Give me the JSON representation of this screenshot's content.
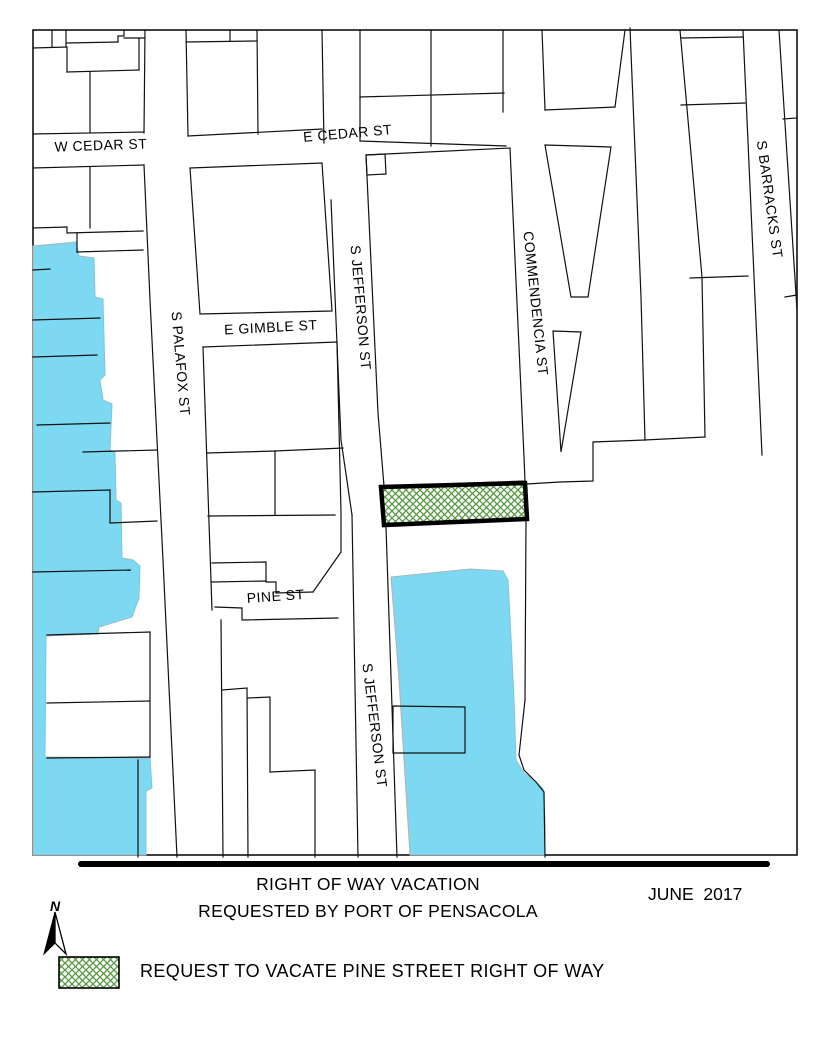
{
  "title_block": {
    "line1": "RIGHT OF WAY VACATION",
    "line2": "REQUESTED BY PORT OF PENSACOLA",
    "date": "JUNE  2017"
  },
  "north": {
    "label": "N"
  },
  "legend": {
    "item_label": "REQUEST TO VACATE PINE STREET RIGHT OF WAY"
  },
  "colors": {
    "water": "#7CD9F1",
    "water_outline": "#9FB9C2",
    "hatch_green": "#55973F",
    "parcel_line": "#111111",
    "vacation_border": "#000000"
  },
  "map": {
    "frame": {
      "x": 33,
      "y": 30,
      "w": 764,
      "h": 825
    },
    "street_labels": [
      {
        "text": "W CEDAR ST",
        "x": 101,
        "y": 150,
        "rot": -2,
        "size": 14
      },
      {
        "text": "E CEDAR ST",
        "x": 348,
        "y": 138,
        "rot": -5,
        "size": 14
      },
      {
        "text": "E GIMBLE ST",
        "x": 271,
        "y": 332,
        "rot": -3,
        "size": 14
      },
      {
        "text": "S PALAFOX ST",
        "x": 176,
        "y": 364,
        "rot": 85,
        "size": 14
      },
      {
        "text": "S JEFFERSON ST",
        "x": 356,
        "y": 308,
        "rot": 85,
        "size": 14
      },
      {
        "text": "COMMENDENCIA ST",
        "x": 531,
        "y": 304,
        "rot": 84,
        "size": 14
      },
      {
        "text": "S BARRACKS ST",
        "x": 765,
        "y": 200,
        "rot": 82,
        "size": 14
      },
      {
        "text": "PINE ST",
        "x": 276,
        "y": 601,
        "rot": -4,
        "size": 14
      },
      {
        "text": "S JEFFERSON ST",
        "x": 370,
        "y": 726,
        "rot": 83,
        "size": 14
      }
    ],
    "water_polygons": [
      [
        [
          33,
          246
        ],
        [
          76,
          242
        ],
        [
          79,
          256
        ],
        [
          94,
          258
        ],
        [
          95,
          297
        ],
        [
          103,
          299
        ],
        [
          105,
          375
        ],
        [
          100,
          380
        ],
        [
          103,
          400
        ],
        [
          112,
          404
        ],
        [
          110,
          450
        ],
        [
          115,
          452
        ],
        [
          116,
          500
        ],
        [
          121,
          503
        ],
        [
          122,
          558
        ],
        [
          133,
          560
        ],
        [
          140,
          566
        ],
        [
          139,
          598
        ],
        [
          132,
          617
        ],
        [
          99,
          627
        ],
        [
          98,
          634
        ],
        [
          46,
          636
        ],
        [
          45,
          757
        ],
        [
          150,
          758
        ],
        [
          152,
          788
        ],
        [
          146,
          791
        ],
        [
          146,
          855
        ],
        [
          33,
          855
        ]
      ],
      [
        [
          391,
          577
        ],
        [
          470,
          569
        ],
        [
          503,
          571
        ],
        [
          508,
          580
        ],
        [
          511,
          637
        ],
        [
          514,
          700
        ],
        [
          516,
          760
        ],
        [
          524,
          773
        ],
        [
          535,
          781
        ],
        [
          543,
          789
        ],
        [
          545,
          820
        ],
        [
          545,
          855
        ],
        [
          410,
          855
        ],
        [
          404,
          760
        ],
        [
          399,
          680
        ]
      ]
    ],
    "parcel_polygons": [
      [
        [
          190,
          168
        ],
        [
          322,
          163
        ],
        [
          332,
          311
        ],
        [
          200,
          314
        ]
      ],
      [
        [
          366,
          155
        ],
        [
          510,
          148
        ],
        [
          513,
          215
        ],
        [
          524,
          457
        ],
        [
          525,
          481
        ],
        [
          384,
          486
        ],
        [
          378,
          413
        ]
      ],
      [
        [
          366,
          155
        ],
        [
          385,
          154
        ],
        [
          386,
          174
        ],
        [
          367,
          175
        ]
      ],
      [
        [
          545,
          145
        ],
        [
          611,
          147
        ],
        [
          588,
          297
        ],
        [
          571,
          297
        ]
      ],
      [
        [
          553,
          331
        ],
        [
          581,
          332
        ],
        [
          561,
          452
        ]
      ],
      [
        [
          393,
          706
        ],
        [
          465,
          707
        ],
        [
          465,
          753
        ],
        [
          393,
          753
        ]
      ]
    ],
    "parcel_lines": [
      [
        [
          145,
          30
        ],
        [
          144,
          133
        ]
      ],
      [
        [
          33,
          134
        ],
        [
          144,
          132
        ]
      ],
      [
        [
          33,
          48
        ],
        [
          67,
          47
        ]
      ],
      [
        [
          67,
          43
        ],
        [
          118,
          42
        ]
      ],
      [
        [
          52,
          30
        ],
        [
          52,
          47
        ]
      ],
      [
        [
          66,
          30
        ],
        [
          66,
          47
        ]
      ],
      [
        [
          118,
          42
        ],
        [
          118,
          36
        ],
        [
          124,
          36
        ],
        [
          124,
          30
        ]
      ],
      [
        [
          124,
          38
        ],
        [
          144,
          38
        ]
      ],
      [
        [
          139,
          38
        ],
        [
          139,
          70
        ]
      ],
      [
        [
          67,
          48
        ],
        [
          67,
          72
        ]
      ],
      [
        [
          67,
          72
        ],
        [
          139,
          70
        ]
      ],
      [
        [
          90,
          72
        ],
        [
          90,
          132
        ]
      ],
      [
        [
          186,
          30
        ],
        [
          188,
          136
        ]
      ],
      [
        [
          257,
          30
        ],
        [
          258,
          134
        ]
      ],
      [
        [
          188,
          136
        ],
        [
          322,
          129
        ]
      ],
      [
        [
          186,
          42
        ],
        [
          257,
          41
        ]
      ],
      [
        [
          230,
          30
        ],
        [
          230,
          41
        ]
      ],
      [
        [
          322,
          30
        ],
        [
          324,
          143
        ]
      ],
      [
        [
          360,
          30
        ],
        [
          360,
          140
        ]
      ],
      [
        [
          360,
          97
        ],
        [
          504,
          93
        ]
      ],
      [
        [
          431,
          30
        ],
        [
          431,
          146
        ]
      ],
      [
        [
          503,
          30
        ],
        [
          503,
          112
        ]
      ],
      [
        [
          360,
          141
        ],
        [
          506,
          146
        ]
      ],
      [
        [
          542,
          30
        ],
        [
          545,
          110
        ]
      ],
      [
        [
          545,
          110
        ],
        [
          615,
          107
        ]
      ],
      [
        [
          615,
          107
        ],
        [
          625,
          30
        ]
      ],
      [
        [
          630,
          28
        ],
        [
          641,
          297
        ],
        [
          645,
          440
        ]
      ],
      [
        [
          680,
          30
        ],
        [
          702,
          277
        ],
        [
          705,
          437
        ]
      ],
      [
        [
          681,
          38
        ],
        [
          743,
          37
        ]
      ],
      [
        [
          681,
          105
        ],
        [
          745,
          103
        ]
      ],
      [
        [
          690,
          278
        ],
        [
          748,
          276
        ]
      ],
      [
        [
          743,
          30
        ],
        [
          762,
          455
        ]
      ],
      [
        [
          779,
          30
        ],
        [
          797,
          310
        ]
      ],
      [
        [
          783,
          119
        ],
        [
          797,
          118
        ]
      ],
      [
        [
          785,
          297
        ],
        [
          797,
          295
        ]
      ],
      [
        [
          645,
          440
        ],
        [
          593,
          442
        ],
        [
          593,
          481
        ],
        [
          560,
          482
        ],
        [
          527,
          484
        ]
      ],
      [
        [
          705,
          437
        ],
        [
          645,
          440
        ]
      ],
      [
        [
          526,
          519
        ],
        [
          525,
          700
        ]
      ],
      [
        [
          525,
          700
        ],
        [
          519,
          755
        ],
        [
          524,
          770
        ],
        [
          536,
          782
        ],
        [
          544,
          792
        ],
        [
          545,
          857
        ]
      ],
      [
        [
          203,
          347
        ],
        [
          337,
          342
        ]
      ],
      [
        [
          203,
          347
        ],
        [
          212,
          610
        ]
      ],
      [
        [
          337,
          342
        ],
        [
          341,
          513
        ],
        [
          341,
          552
        ]
      ],
      [
        [
          208,
          516
        ],
        [
          335,
          515
        ]
      ],
      [
        [
          341,
          552
        ],
        [
          313,
          592
        ]
      ],
      [
        [
          313,
          592
        ],
        [
          276,
          593
        ],
        [
          276,
          582
        ],
        [
          266,
          582
        ],
        [
          266,
          562
        ],
        [
          212,
          563
        ]
      ],
      [
        [
          212,
          582
        ],
        [
          266,
          581
        ]
      ],
      [
        [
          207,
          453
        ],
        [
          275,
          451
        ]
      ],
      [
        [
          275,
          451
        ],
        [
          275,
          515
        ]
      ],
      [
        [
          275,
          451
        ],
        [
          343,
          448
        ]
      ],
      [
        [
          352,
          515
        ],
        [
          358,
          857
        ]
      ],
      [
        [
          331,
          200
        ],
        [
          341,
          440
        ],
        [
          352,
          515
        ]
      ],
      [
        [
          215,
          607
        ],
        [
          242,
          608
        ],
        [
          242,
          620
        ],
        [
          338,
          618
        ]
      ],
      [
        [
          221,
          620
        ],
        [
          223,
          857
        ]
      ],
      [
        [
          222,
          690
        ],
        [
          247,
          688
        ],
        [
          248,
          857
        ]
      ],
      [
        [
          248,
          698
        ],
        [
          270,
          697
        ],
        [
          270,
          772
        ]
      ],
      [
        [
          270,
          772
        ],
        [
          315,
          770
        ],
        [
          315,
          857
        ]
      ],
      [
        [
          386,
          527
        ],
        [
          397,
          857
        ]
      ],
      [
        [
          144,
          165
        ],
        [
          150,
          300
        ],
        [
          163,
          560
        ],
        [
          177,
          857
        ]
      ],
      [
        [
          33,
          168
        ],
        [
          144,
          165
        ]
      ],
      [
        [
          90,
          167
        ],
        [
          90,
          228
        ]
      ],
      [
        [
          33,
          228
        ],
        [
          67,
          227
        ],
        [
          67,
          233
        ],
        [
          143,
          231
        ]
      ],
      [
        [
          77,
          233
        ],
        [
          77,
          252
        ]
      ],
      [
        [
          77,
          252
        ],
        [
          143,
          250
        ]
      ],
      [
        [
          33,
          270
        ],
        [
          50,
          269
        ]
      ],
      [
        [
          33,
          320
        ],
        [
          100,
          318
        ]
      ],
      [
        [
          33,
          357
        ],
        [
          97,
          355
        ]
      ],
      [
        [
          37,
          425
        ],
        [
          110,
          423
        ]
      ],
      [
        [
          83,
          452
        ],
        [
          157,
          450
        ]
      ],
      [
        [
          33,
          492
        ],
        [
          110,
          490
        ]
      ],
      [
        [
          110,
          490
        ],
        [
          110,
          523
        ]
      ],
      [
        [
          110,
          523
        ],
        [
          157,
          521
        ]
      ],
      [
        [
          33,
          572
        ],
        [
          130,
          570
        ]
      ],
      [
        [
          47,
          635
        ],
        [
          150,
          632
        ]
      ],
      [
        [
          47,
          703
        ],
        [
          150,
          701
        ]
      ],
      [
        [
          47,
          758
        ],
        [
          150,
          757
        ]
      ],
      [
        [
          150,
          632
        ],
        [
          150,
          757
        ]
      ],
      [
        [
          138,
          760
        ],
        [
          138,
          857
        ]
      ]
    ],
    "vacation_polygon": [
      [
        381,
        487
      ],
      [
        525,
        483
      ],
      [
        527,
        519
      ],
      [
        384,
        525
      ]
    ]
  }
}
